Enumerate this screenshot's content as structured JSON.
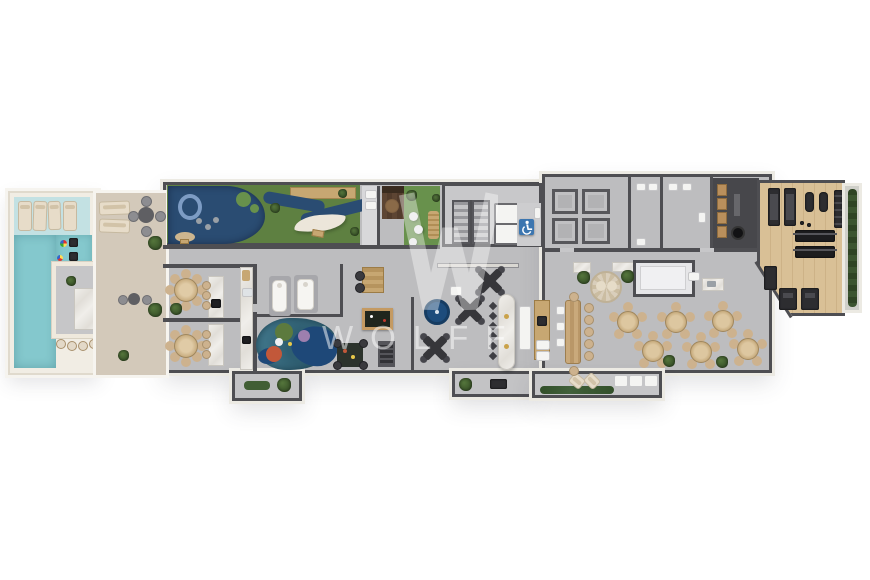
{
  "watermark": {
    "logo_letter": "W",
    "text": "WOLFF"
  },
  "icons": {
    "wheelchair": "accessible-wheelchair-icon"
  },
  "palette": {
    "wall": "#4e4e52",
    "wall2": "#6a6a6e",
    "frame": "#eceae3",
    "floor": "#bdbdbf",
    "floor2": "#c7c7c9",
    "cream": "#f1ede4",
    "deck": "#d3c9ba",
    "water": "#84c8cd",
    "water2": "#c3e1e3",
    "lawn": "#5e8041",
    "lawn2": "#68914c",
    "rubber": "#2a4c72",
    "navy": "#1e4878",
    "teal": "#3e7387",
    "blue": "#1d4c7c",
    "gym": "#d9c096",
    "wood": "#5d4533",
    "tan": "#c7a772",
    "beige": "#cdb28e",
    "marbleA": "#f0eeea",
    "marbleB": "#e1ded8",
    "plant": "#3a5429",
    "dark": "#2d2d30",
    "steel": "#9aa0a6",
    "sign": "#3c76b0",
    "green": "#5c7a3e",
    "purple": "#9d7fae",
    "orange": "#c2583a",
    "wm": "rgba(255,255,255,0.5)"
  },
  "areas": [
    "swimming-pool",
    "wet-deck-loungers",
    "swim-up-bar",
    "kids-pool",
    "sun-deck",
    "playground",
    "garden-lounge",
    "elevator-core",
    "stairs",
    "accessible-wc",
    "machine-rooms",
    "restrooms",
    "locker-room",
    "gym",
    "pantry-kitchen",
    "dining-hall",
    "communal-table",
    "gourmet-room-1",
    "gourmet-room-2",
    "massage-spa",
    "kids-playroom",
    "ball-pit",
    "billiards-table",
    "game-lounge",
    "bar-counter",
    "terrace"
  ]
}
